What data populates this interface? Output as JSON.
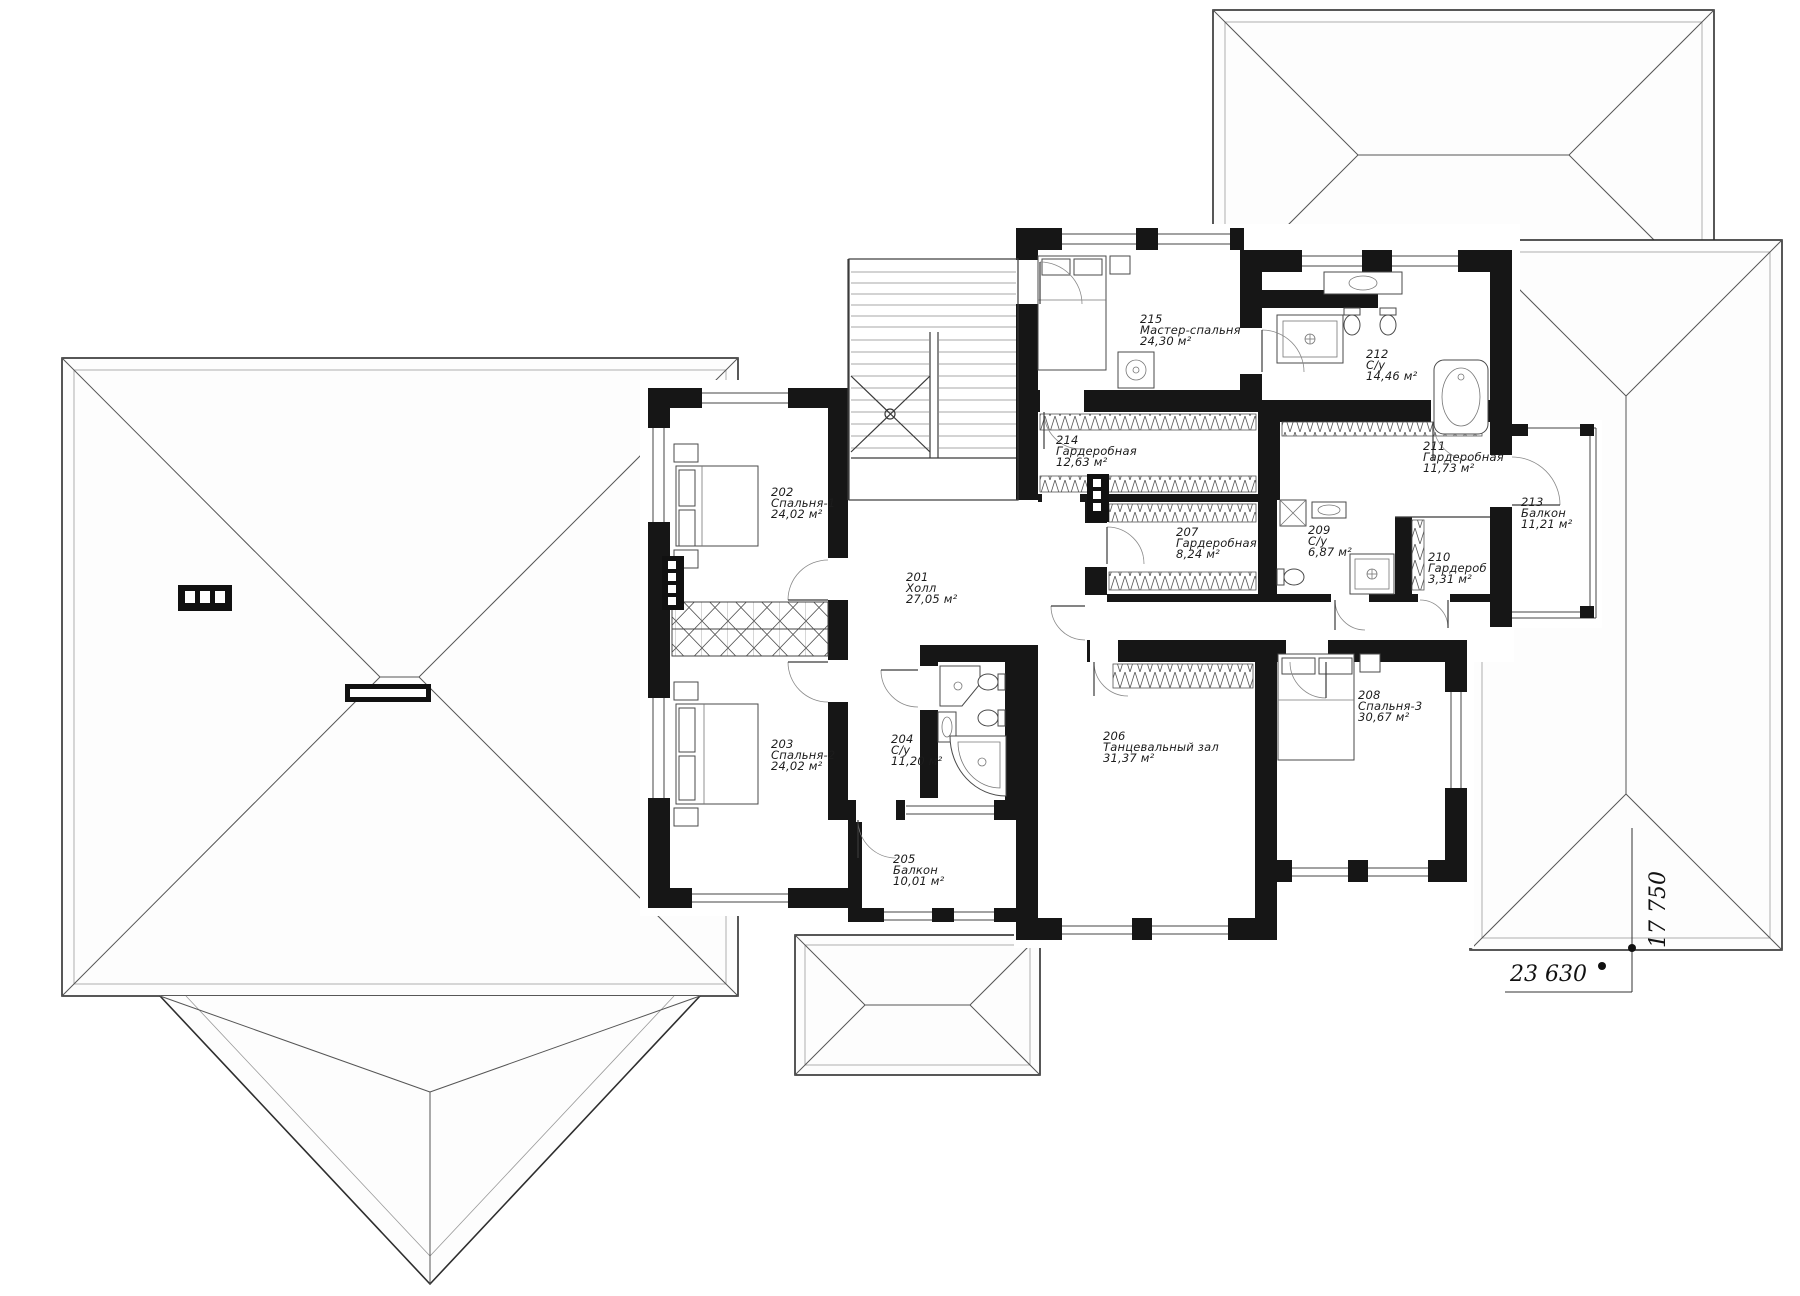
{
  "rooms": [
    {
      "number": "201",
      "name": "Холл",
      "area": "27,05 м²"
    },
    {
      "number": "202",
      "name": "Спальня-1",
      "area": "24,02 м²"
    },
    {
      "number": "203",
      "name": "Спальня-2",
      "area": "24,02 м²"
    },
    {
      "number": "204",
      "name": "С/у",
      "area": "11,20 м²"
    },
    {
      "number": "205",
      "name": "Балкон",
      "area": "10,01 м²"
    },
    {
      "number": "206",
      "name": "Танцевальный зал",
      "area": "31,37 м²"
    },
    {
      "number": "207",
      "name": "Гардеробная",
      "area": "8,24 м²"
    },
    {
      "number": "208",
      "name": "Спальня-3",
      "area": "30,67 м²"
    },
    {
      "number": "209",
      "name": "С/у",
      "area": "6,87 м²"
    },
    {
      "number": "210",
      "name": "Гардероб",
      "area": "3,31 м²"
    },
    {
      "number": "211",
      "name": "Гардеробная",
      "area": "11,73 м²"
    },
    {
      "number": "212",
      "name": "С/у",
      "area": "14,46 м²"
    },
    {
      "number": "213",
      "name": "Балкон",
      "area": "11,21 м²"
    },
    {
      "number": "214",
      "name": "Гардеробная",
      "area": "12,63 м²"
    },
    {
      "number": "215",
      "name": "Мастер-спальня",
      "area": "24,30 м²"
    }
  ],
  "dimensions": {
    "width": "23 630",
    "depth": "17 750"
  },
  "colors": {
    "walls": "#161616",
    "background": "#ffffff",
    "roof_lines": "#2e2e2e"
  }
}
